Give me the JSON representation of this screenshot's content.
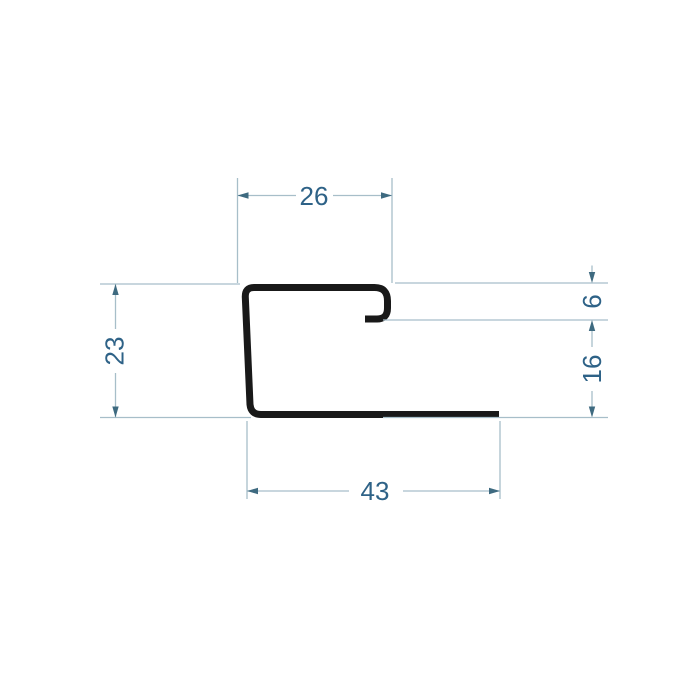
{
  "drawing": {
    "dimensions": {
      "top_width": "26",
      "lip_height": "6",
      "side_height": "16",
      "left_height": "23",
      "bottom_width": "43"
    }
  },
  "colors": {
    "background": "#ffffff",
    "profile": "#191919",
    "dimline": "#a7bec9",
    "arrow": "#3e6a80",
    "text": "#2e6287"
  }
}
